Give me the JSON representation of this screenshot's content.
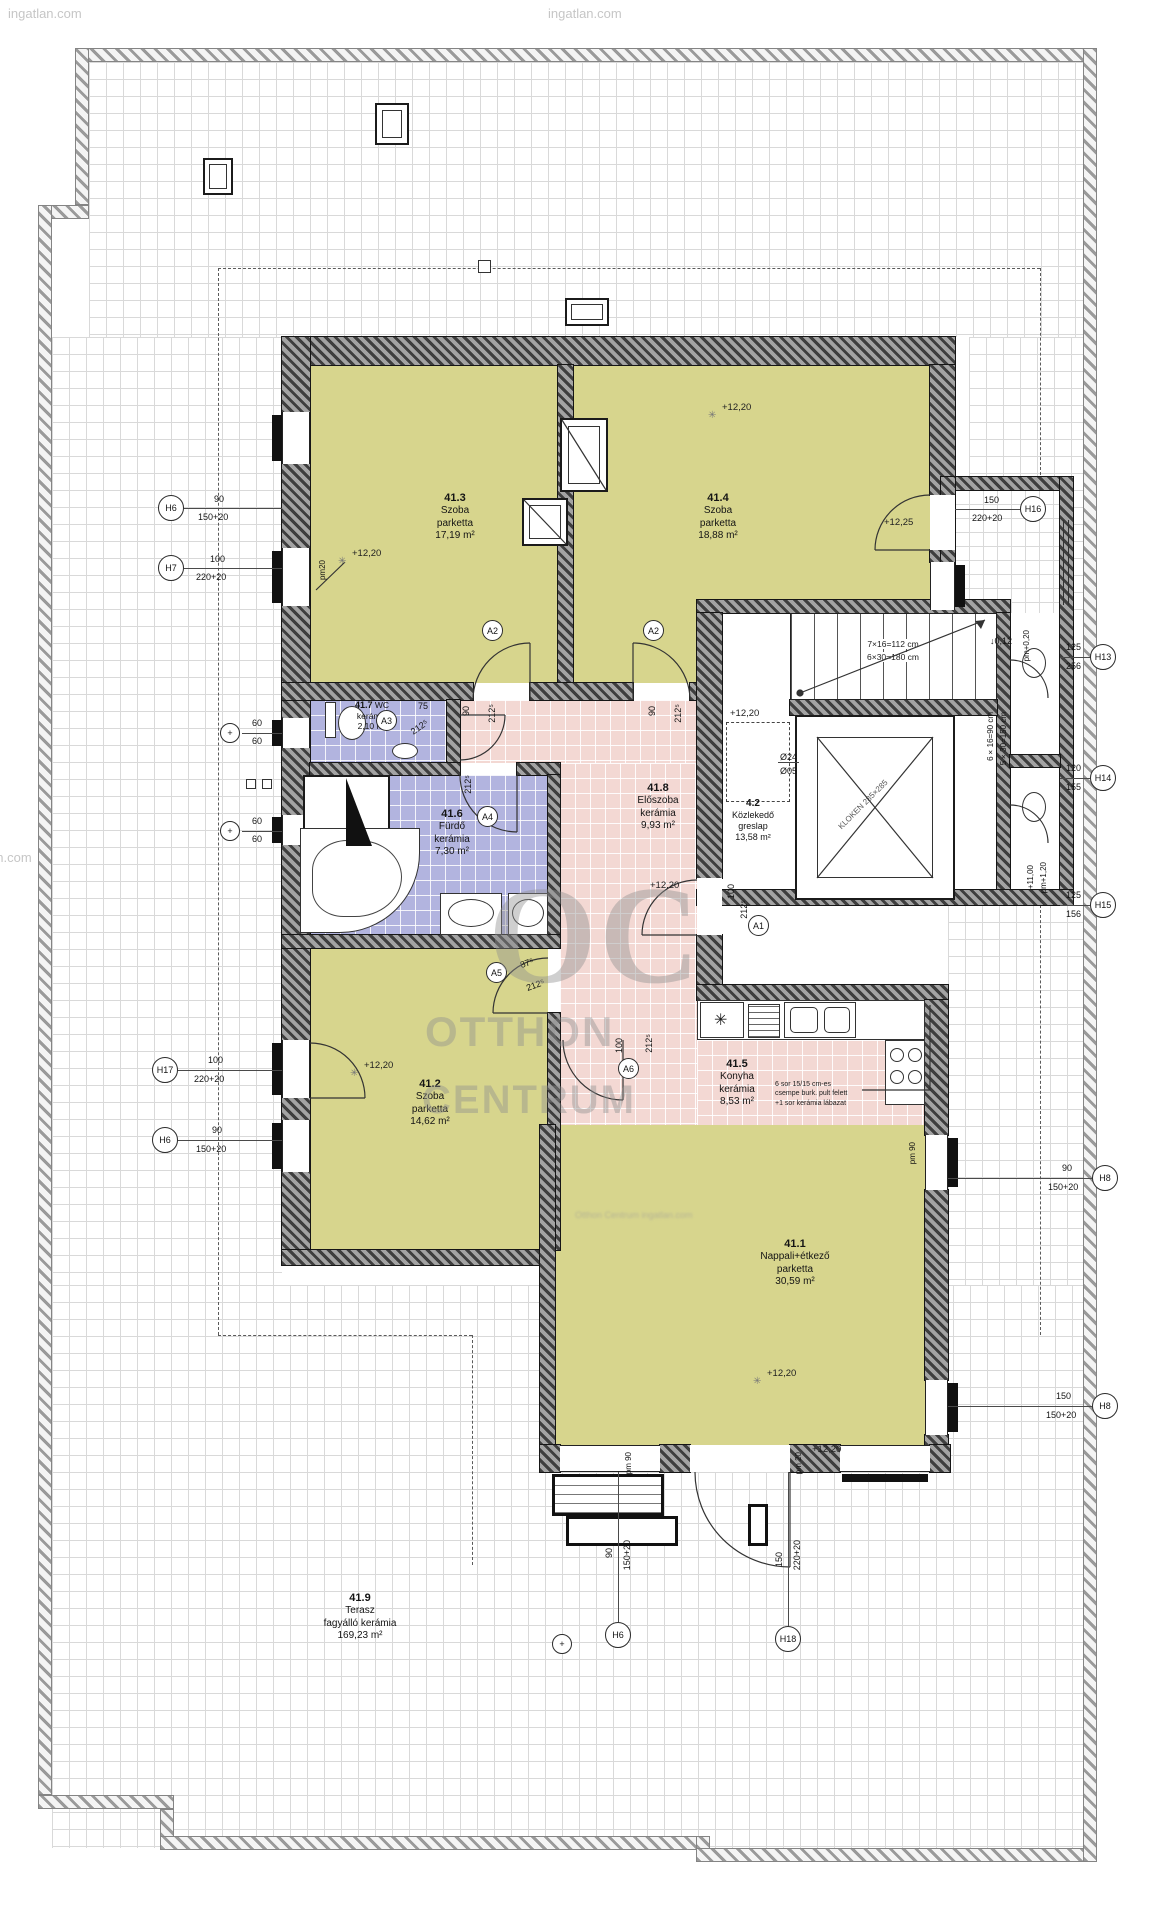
{
  "watermarks": {
    "top_left": "ingatlan.com",
    "top_center": "ingatlan.com",
    "left_edge": "ingatlan.com",
    "logo_oc": "OC",
    "logo_l1": "OTTHON",
    "logo_l2": "CENTRUM",
    "blur_line": "Otthon Centrum ingatlan.com"
  },
  "rooms": [
    {
      "id": "41.3",
      "name": "Szoba",
      "finish": "parketta",
      "area": "17,19 m²"
    },
    {
      "id": "41.4",
      "name": "Szoba",
      "finish": "parketta",
      "area": "18,88 m²"
    },
    {
      "id": "41.7",
      "name": "WC",
      "finish": "kerámia",
      "area": "2,10 m²"
    },
    {
      "id": "41.6",
      "name": "Fürdő",
      "finish": "kerámia",
      "area": "7,30 m²"
    },
    {
      "id": "41.8",
      "name": "Előszoba",
      "finish": "kerámia",
      "area": "9,93 m²"
    },
    {
      "id": "4.2",
      "name": "Közlekedő",
      "finish": "greslap",
      "area": "13,58 m²"
    },
    {
      "id": "41.5",
      "name": "Konyha",
      "finish": "kerámia",
      "area": "8,53 m²"
    },
    {
      "id": "41.2",
      "name": "Szoba",
      "finish": "parketta",
      "area": "14,62 m²"
    },
    {
      "id": "41.1",
      "name": "Nappali+étkező",
      "finish": "parketta",
      "area": "30,59 m²"
    },
    {
      "id": "41.9",
      "name": "Terasz",
      "finish": "fagyálló kerámia",
      "area": "169,23 m²"
    }
  ],
  "levels": {
    "l1": "+12,20",
    "l2": "+12,20",
    "l3": "+12,20",
    "l4": "+12,20",
    "l5": "+12,25",
    "l6": "+12,20",
    "l7": "+12,20",
    "l8": "+12,20"
  },
  "stairs": {
    "main1": "7×16=112 cm",
    "main2": "6×30=180 cm",
    "side1": "6×16=90 cm",
    "side2": "5×30=150 cm"
  },
  "elevator_label": "KLOKEN 285×285",
  "kitchen_note": [
    "6 sor 15/15 cm-es",
    "csempe burk. pult felett",
    "+1 sor kerámia lábazat"
  ],
  "doors": {
    "d1w": "90",
    "d1h": "212⁵",
    "d1c": "A2",
    "d2w": "90",
    "d2h": "212⁵",
    "d2c": "A2",
    "d3w": "75",
    "d3h": "212⁵",
    "d3c": "A3",
    "d4h": "212⁵",
    "d4c": "A4",
    "d5w": "100",
    "d5h": "212⁵",
    "d5c": "A1",
    "d6w": "87⁵",
    "d6h": "212⁵",
    "d6c": "A5",
    "d7w": "100",
    "d7h": "212⁵",
    "d7c": "A6"
  },
  "chains": {
    "left": [
      {
        "c": "H6",
        "a": "90",
        "b": "150+20"
      },
      {
        "c": "H7",
        "a": "100",
        "b": "220+20"
      },
      {
        "c": "+",
        "a": "60",
        "b": "60"
      },
      {
        "c": "+",
        "a": "60",
        "b": "60"
      },
      {
        "c": "H17",
        "a": "100",
        "b": "220+20"
      },
      {
        "c": "H6",
        "a": "90",
        "b": "150+20"
      }
    ],
    "right": [
      {
        "c": "H16",
        "a": "150",
        "b": "220+20"
      },
      {
        "c": "H13",
        "a": "125",
        "b": "256"
      },
      {
        "c": "H14",
        "a": "120",
        "b": "155"
      },
      {
        "c": "H15",
        "a": "125",
        "b": "156"
      },
      {
        "c": "H8",
        "a": "90",
        "b": "150+20"
      },
      {
        "c": "H8",
        "a": "150",
        "b": "150+20"
      }
    ],
    "bottom": [
      {
        "c": "H6",
        "a": "90",
        "b": "150+20"
      },
      {
        "c": "H18",
        "a": "150",
        "b": "220+20"
      }
    ]
  },
  "misc": {
    "drop": "↓0,12",
    "pm020": "pm+0,20",
    "pm120": "pm+1,20",
    "p1100": "+11,00",
    "o24": "Ø24",
    "o05": "Ø05",
    "pm20": "pm20",
    "pm90a": "pm 90",
    "pm90b": "pm 90",
    "pm20b": "pm 20",
    "sparkle": "✳",
    "fridge": "✳"
  }
}
